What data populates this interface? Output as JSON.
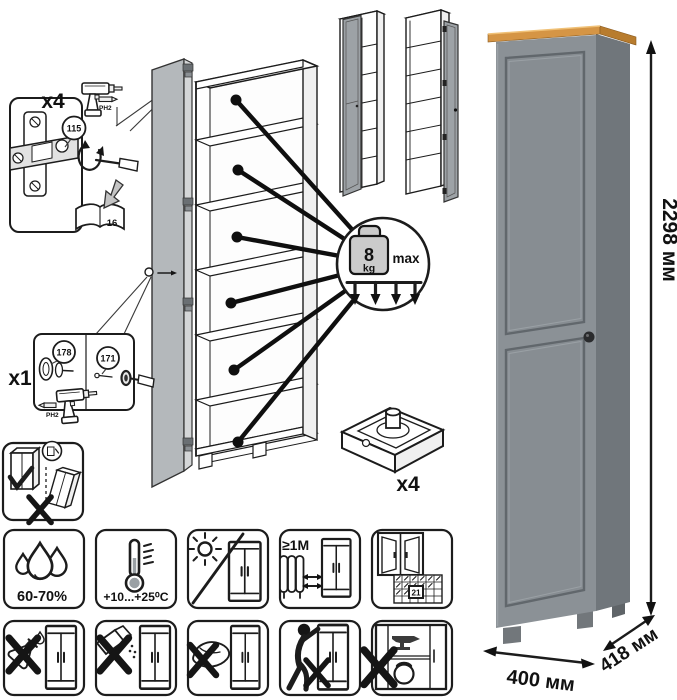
{
  "colors": {
    "cabinet_front": "#8b9196",
    "cabinet_side": "#70767b",
    "panel_recess": "#878d92",
    "door_front": "#b4b8bb",
    "door_edge": "#d4d6d7",
    "mini_door": "#9da2a6",
    "wood_front": "#d59545",
    "wood_side": "#b87c2e",
    "knob": "#2a2b2d",
    "weight_fill": "#cbcbcb"
  },
  "assembly": {
    "hinge_step": {
      "count": "x4",
      "part_id": "115",
      "bit_label": "PH2",
      "manual_page": "16"
    },
    "handle_step": {
      "count": "x1",
      "part_id_a": "178",
      "part_id_b": "171",
      "bit_label": "PH2"
    },
    "shelf_load": {
      "value": "8",
      "unit": "kg",
      "qualifier": "max"
    },
    "feet_step": {
      "count": "x4"
    }
  },
  "dimensions": {
    "height": "2298 мм",
    "width": "400 мм",
    "depth": "418 мм"
  },
  "care": {
    "humidity_label": "60-70%",
    "temperature_label": "+10...+25⁰C",
    "radiator_distance_label": "≥1М",
    "acclimatization_days": "21"
  }
}
